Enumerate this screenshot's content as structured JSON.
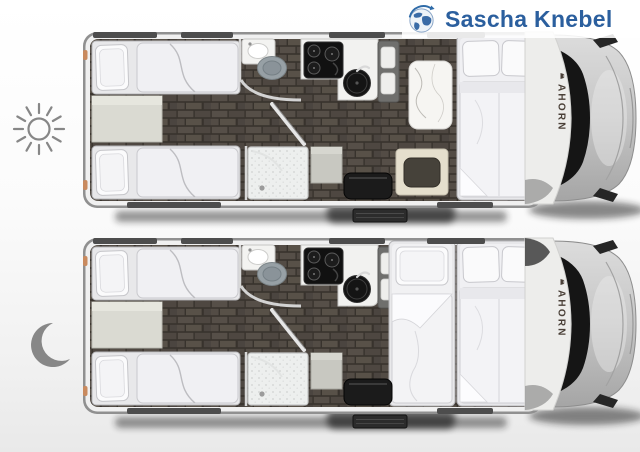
{
  "header": {
    "brand_text": "Sascha Knebel",
    "logo_icon": "globe-icon"
  },
  "vehicle": {
    "brand_label": "AHORN"
  },
  "modes": {
    "day": {
      "icon": "sun-icon"
    },
    "night": {
      "icon": "moon-icon"
    }
  },
  "colors": {
    "logo_blue": "#2b5f9e",
    "icon_gray": "#878787",
    "floor_tile": "#4f4942",
    "grout": "#38332d",
    "bed_white": "#f0f0f3",
    "counter_white": "#f2f2f0",
    "appliance_black": "#141414",
    "bench_gray": "#6f6f6d",
    "seat_cream": "#e5dfcd",
    "seat_dark": "#1b1b1b",
    "cab_silver": "#c6c6c6",
    "windshield": "#151515",
    "window_bar": "#4d4d4d",
    "wall_light": "#d8d8d8",
    "ahorn_brown": "#4a4038",
    "tail_light": "#c98a5e"
  }
}
